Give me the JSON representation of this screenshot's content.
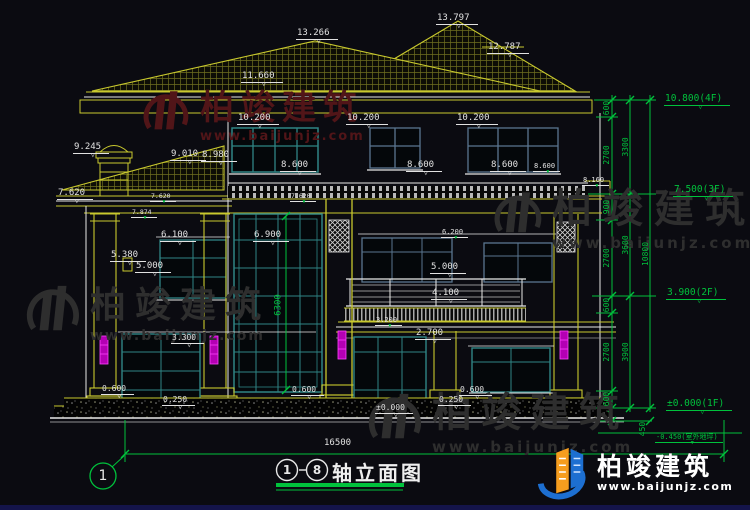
{
  "drawing": {
    "title": {
      "axis_from": "1",
      "axis_to": "8",
      "name": "轴立面图"
    },
    "axis_bubble": "1"
  },
  "watermarks": {
    "brand": "柏竣建筑",
    "url": "www.baijunjz.com"
  },
  "logo": {
    "brand": "柏竣建筑",
    "url": "www.baijunjz.com"
  },
  "colors": {
    "background": "#0b0b11",
    "line_white": "#e8e8e8",
    "line_yellow": "#c9c92e",
    "line_green": "#00c23c",
    "window_teal": "#2f8585",
    "window_slate": "#5a7690",
    "downspout_magenta": "#d022d0",
    "watermark_red": "#511518",
    "watermark_gray": "#2e2e2e",
    "logo_blue": "#1d6fd1",
    "logo_orange": "#f59d1e"
  },
  "annotations": [
    {
      "t": "13.797",
      "x": 436,
      "y": 14,
      "s": 9,
      "c": "w",
      "r": 0,
      "m": 1
    },
    {
      "t": "13.266",
      "x": 296,
      "y": 29,
      "s": 9,
      "c": "w",
      "r": 0,
      "m": 1
    },
    {
      "t": "12.787",
      "x": 487,
      "y": 43,
      "s": 9,
      "c": "w",
      "r": 0,
      "m": 1
    },
    {
      "t": "11.660",
      "x": 241,
      "y": 72,
      "s": 9,
      "c": "w",
      "r": 0,
      "m": 1
    },
    {
      "t": "10.200",
      "x": 237,
      "y": 114,
      "s": 9,
      "c": "w",
      "r": 0,
      "m": 1
    },
    {
      "t": "10.200",
      "x": 346,
      "y": 114,
      "s": 9,
      "c": "w",
      "r": 0,
      "m": 1
    },
    {
      "t": "10.200",
      "x": 456,
      "y": 114,
      "s": 9,
      "c": "w",
      "r": 0,
      "m": 1
    },
    {
      "t": "9.245",
      "x": 73,
      "y": 143,
      "s": 9,
      "c": "w",
      "r": 0,
      "m": 1
    },
    {
      "t": "9.010",
      "x": 170,
      "y": 150,
      "s": 9,
      "c": "w",
      "r": 0,
      "m": 1
    },
    {
      "t": "8.980",
      "x": 201,
      "y": 151,
      "s": 9,
      "c": "w",
      "r": 0,
      "m": 1
    },
    {
      "t": "8.600",
      "x": 280,
      "y": 161,
      "s": 9,
      "c": "w",
      "r": 0,
      "m": 1
    },
    {
      "t": "8.600",
      "x": 406,
      "y": 161,
      "s": 9,
      "c": "w",
      "r": 0,
      "m": 1
    },
    {
      "t": "8.600",
      "x": 490,
      "y": 161,
      "s": 9,
      "c": "w",
      "r": 0,
      "m": 1
    },
    {
      "t": "8.600",
      "x": 533,
      "y": 163,
      "s": 7,
      "c": "w",
      "r": 0,
      "m": 2
    },
    {
      "t": "8.160",
      "x": 582,
      "y": 177,
      "s": 7,
      "c": "w",
      "r": 0,
      "m": 2
    },
    {
      "t": "7.620",
      "x": 57,
      "y": 189,
      "s": 9,
      "c": "w",
      "r": 0,
      "m": 1
    },
    {
      "t": "7.620",
      "x": 150,
      "y": 193,
      "s": 6.5,
      "c": "w",
      "r": 0,
      "m": 2
    },
    {
      "t": "7.874",
      "x": 131,
      "y": 209,
      "s": 6.5,
      "c": "w",
      "r": 0,
      "m": 2
    },
    {
      "t": "7.620",
      "x": 290,
      "y": 193,
      "s": 6.5,
      "c": "w",
      "r": 0,
      "m": 2
    },
    {
      "t": "6.900",
      "x": 253,
      "y": 231,
      "s": 9,
      "c": "w",
      "r": 0,
      "m": 1
    },
    {
      "t": "6.100",
      "x": 160,
      "y": 231,
      "s": 9,
      "c": "w",
      "r": 0,
      "m": 1
    },
    {
      "t": "5.380",
      "x": 110,
      "y": 251,
      "s": 9,
      "c": "w",
      "r": 0,
      "m": 1
    },
    {
      "t": "5.000",
      "x": 135,
      "y": 262,
      "s": 9,
      "c": "w",
      "r": 0,
      "m": 1
    },
    {
      "t": "6.200",
      "x": 441,
      "y": 229,
      "s": 7,
      "c": "w",
      "r": 0,
      "m": 2
    },
    {
      "t": "5.000",
      "x": 430,
      "y": 263,
      "s": 9,
      "c": "w",
      "r": 0,
      "m": 1
    },
    {
      "t": "4.100",
      "x": 431,
      "y": 289,
      "s": 9,
      "c": "w",
      "r": 0,
      "m": 1
    },
    {
      "t": "3.300",
      "x": 171,
      "y": 334,
      "s": 8,
      "c": "w",
      "r": 0,
      "m": 1
    },
    {
      "t": "3.200",
      "x": 375,
      "y": 317,
      "s": 7,
      "c": "w",
      "r": 0,
      "m": 2
    },
    {
      "t": "2.700",
      "x": 415,
      "y": 329,
      "s": 9,
      "c": "w",
      "r": 0,
      "m": 1
    },
    {
      "t": "0.600",
      "x": 101,
      "y": 385,
      "s": 8,
      "c": "w",
      "r": 0,
      "m": 1
    },
    {
      "t": "0.250",
      "x": 162,
      "y": 396,
      "s": 8,
      "c": "w",
      "r": 0,
      "m": 1
    },
    {
      "t": "0.600",
      "x": 291,
      "y": 386,
      "s": 8,
      "c": "w",
      "r": 0,
      "m": 1
    },
    {
      "t": "0.250",
      "x": 438,
      "y": 396,
      "s": 8,
      "c": "w",
      "r": 0,
      "m": 1
    },
    {
      "t": "0.600",
      "x": 459,
      "y": 386,
      "s": 8,
      "c": "w",
      "r": 0,
      "m": 1
    },
    {
      "t": "±0.000",
      "x": 375,
      "y": 404,
      "s": 8,
      "c": "w",
      "r": 0,
      "m": 1
    },
    {
      "t": "10.800(4F)",
      "x": 664,
      "y": 94,
      "s": 9.5,
      "c": "g",
      "r": 0,
      "m": 1
    },
    {
      "t": "7.500(3F)",
      "x": 673,
      "y": 185,
      "s": 9.5,
      "c": "g",
      "r": 0,
      "m": 1
    },
    {
      "t": "3.900(2F)",
      "x": 666,
      "y": 288,
      "s": 9.5,
      "c": "g",
      "r": 0,
      "m": 1
    },
    {
      "t": "±0.000(1F)",
      "x": 666,
      "y": 399,
      "s": 9.5,
      "c": "g",
      "r": 0,
      "m": 1
    },
    {
      "t": "-0.450(室外地坪)",
      "x": 655,
      "y": 434,
      "s": 7,
      "c": "g",
      "r": 0,
      "m": 2
    },
    {
      "t": "600",
      "x": 607,
      "y": 108,
      "s": 8,
      "c": "g",
      "r": 1,
      "m": 0
    },
    {
      "t": "2700",
      "x": 607,
      "y": 155,
      "s": 8,
      "c": "g",
      "r": 1,
      "m": 0
    },
    {
      "t": "900",
      "x": 607,
      "y": 207,
      "s": 8,
      "c": "g",
      "r": 1,
      "m": 0
    },
    {
      "t": "2700",
      "x": 607,
      "y": 258,
      "s": 8,
      "c": "g",
      "r": 1,
      "m": 0
    },
    {
      "t": "600",
      "x": 607,
      "y": 305,
      "s": 8,
      "c": "g",
      "r": 1,
      "m": 0
    },
    {
      "t": "2700",
      "x": 607,
      "y": 352,
      "s": 8,
      "c": "g",
      "r": 1,
      "m": 0
    },
    {
      "t": "600",
      "x": 607,
      "y": 399,
      "s": 8,
      "c": "g",
      "r": 1,
      "m": 0
    },
    {
      "t": "3300",
      "x": 626,
      "y": 147,
      "s": 8,
      "c": "g",
      "r": 1,
      "m": 0
    },
    {
      "t": "3600",
      "x": 626,
      "y": 245,
      "s": 8,
      "c": "g",
      "r": 1,
      "m": 0
    },
    {
      "t": "3900",
      "x": 626,
      "y": 352,
      "s": 8,
      "c": "g",
      "r": 1,
      "m": 0
    },
    {
      "t": "10800",
      "x": 646,
      "y": 254,
      "s": 8,
      "c": "g",
      "r": 1,
      "m": 0
    },
    {
      "t": "450",
      "x": 643,
      "y": 429,
      "s": 8,
      "c": "g",
      "r": 1,
      "m": 0
    },
    {
      "t": "6300",
      "x": 279,
      "y": 305,
      "s": 9,
      "c": "g",
      "r": 1,
      "m": 0
    },
    {
      "t": "16500",
      "x": 324,
      "y": 439,
      "s": 9,
      "c": "w",
      "r": 0,
      "m": 0
    }
  ]
}
